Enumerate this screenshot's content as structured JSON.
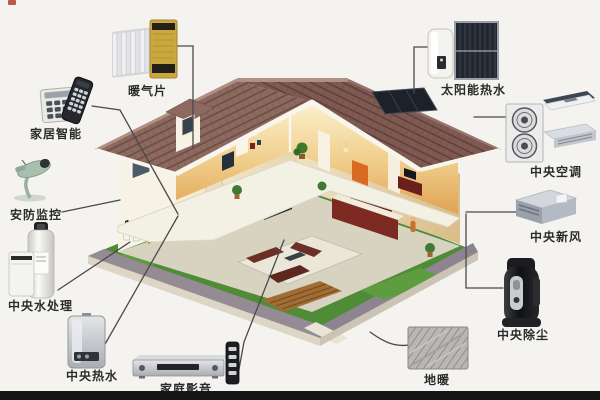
{
  "diagram": {
    "type": "smart-home-systems-cutaway-diagram",
    "background_color": "#f4f3ef",
    "connector_color": "#4a4a4a",
    "label_color": "#2b2b2b",
    "house_colors": {
      "roof": "#8d6a60",
      "roof_dark": "#7f5a52",
      "wall": "#f6f2e6",
      "warm_interior": "#dfa355",
      "lawn": "#4e8c38",
      "path": "#958b95",
      "solar_roof_panel": "#1d222a"
    },
    "labels": {
      "radiator": "暖气片",
      "smart_home": "家居智能",
      "security": "安防监控",
      "water_treatment": "中央水处理",
      "central_hot_water": "中央热水",
      "home_av": "家庭影音",
      "floor_heating": "地暖",
      "central_vacuum": "中央除尘",
      "fresh_air": "中央新风",
      "central_ac": "中央空调",
      "solar_hot_water": "太阳能热水"
    },
    "devices": {
      "radiator": [
        "white-radiator-icon",
        "yellow-radiator-icon"
      ],
      "smart_home": [
        "control-keypad-icon",
        "remote-control-icon"
      ],
      "security": [
        "security-camera-icon"
      ],
      "water_treatment": [
        "water-filter-cylinder-icon",
        "water-softener-icon"
      ],
      "central_hot_water": [
        "wall-boiler-icon"
      ],
      "home_av": [
        "av-receiver-icon",
        "av-remote-icon"
      ],
      "floor_heating": [
        "heating-pipe-coil-photo-icon"
      ],
      "central_vacuum": [
        "central-vacuum-unit-icon"
      ],
      "fresh_air": [
        "fresh-air-ventilator-icon"
      ],
      "central_ac": [
        "ac-outdoor-unit-icon",
        "ceiling-cassette-icon",
        "duct-unit-icon"
      ],
      "solar_hot_water": [
        "water-tank-icon",
        "solar-collector-panel-icon"
      ]
    }
  }
}
